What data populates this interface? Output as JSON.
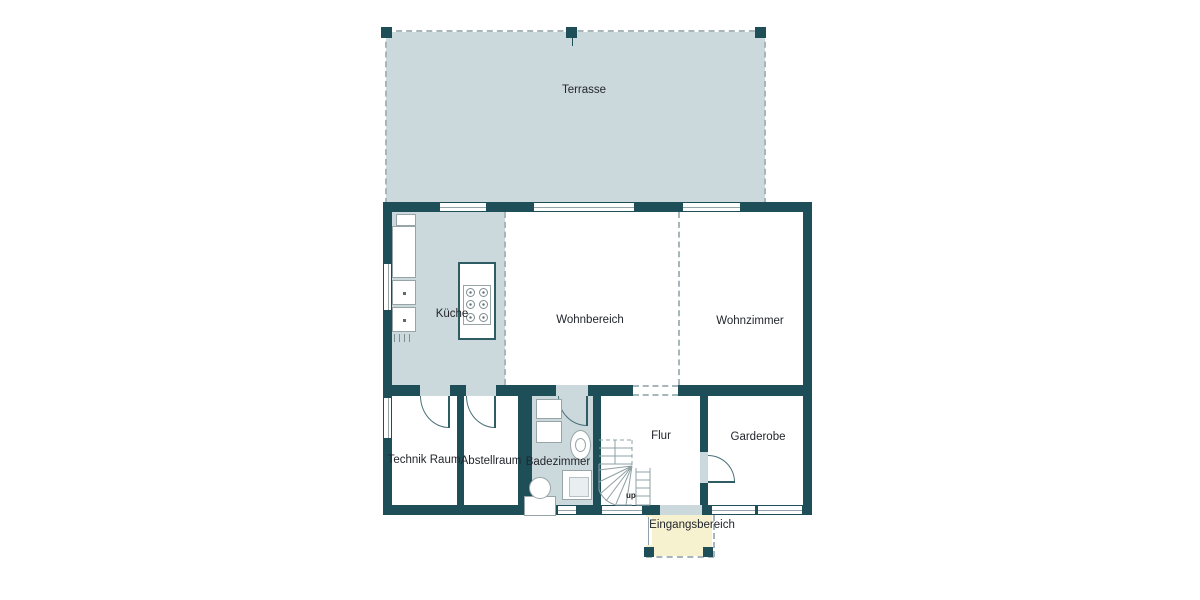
{
  "plan": {
    "type": "ground-floor-plan",
    "rooms": {
      "terrasse": {
        "label": "Terrasse"
      },
      "kueche": {
        "label": "Küche"
      },
      "wohnbereich": {
        "label": "Wohnbereich"
      },
      "wohnzimmer": {
        "label": "Wohnzimmer"
      },
      "technik_raum": {
        "label": "Technik Raum"
      },
      "abstellraum": {
        "label": "Abstellraum"
      },
      "badezimmer": {
        "label": "Badezimmer"
      },
      "flur": {
        "label": "Flur"
      },
      "garderobe": {
        "label": "Garderobe"
      },
      "eingangsbereich": {
        "label": "Eingangsbereich"
      }
    },
    "stairs": {
      "direction_label": "up"
    },
    "colors": {
      "wall": "#1e4f58",
      "room_tint": "#ccd9dc",
      "terrace_fill": "#ccd9dc",
      "entry_fill": "#f6f1cf",
      "dashed_line": "#a8b6ba",
      "label_text": "#22262c",
      "background": "#ffffff"
    }
  }
}
